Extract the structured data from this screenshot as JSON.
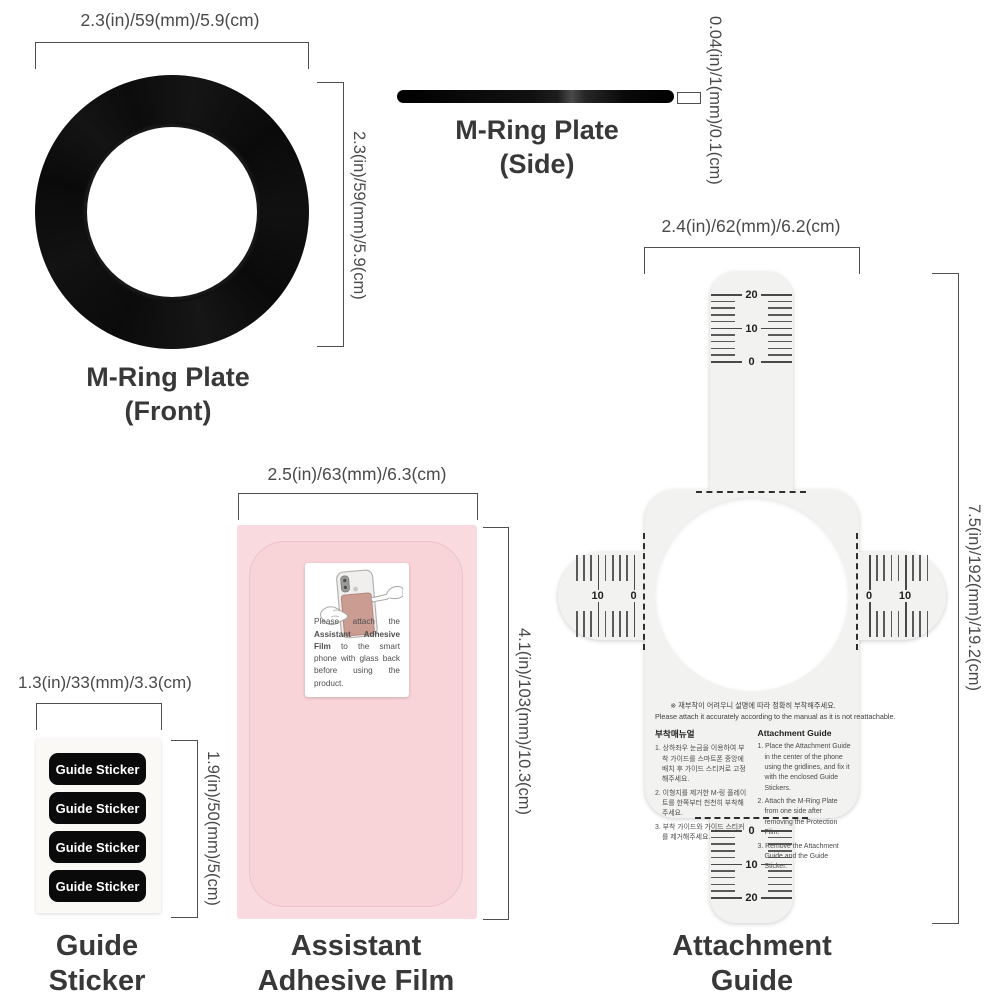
{
  "ring_front": {
    "width_dim": "2.3(in)/59(mm)/5.9(cm)",
    "height_dim": "2.3(in)/59(mm)/5.9(cm)",
    "label_line1": "M-Ring Plate",
    "label_line2": "(Front)",
    "color": "#0d0d0d"
  },
  "ring_side": {
    "thickness_dim": "0.04(in)/1(mm)/0.1(cm)",
    "label_line1": "M-Ring Plate",
    "label_line2": "(Side)"
  },
  "attachment_guide": {
    "width_dim": "2.4(in)/62(mm)/6.2(cm)",
    "height_dim": "7.5(in)/192(mm)/19.2(cm)",
    "label_line1": "Attachment",
    "label_line2": "Guide",
    "rulers": {
      "top": [
        "20",
        "10",
        "0"
      ],
      "bottom": [
        "0",
        "10",
        "20"
      ],
      "left": [
        "10",
        "0"
      ],
      "right": [
        "0",
        "10"
      ]
    },
    "notice_ko": "※ 재부착이 어려우니 설명에 따라 정확히 부착해주세요.",
    "notice_en": "Please attach it accurately according to the manual as it is not reattachable.",
    "manual_ko": {
      "title": "부착매뉴얼",
      "items": [
        "1. 상하좌우 눈금을 이용하여 부착 가이드를 스마트폰 중앙에 배치 후 가이드 스티커로 고정해주세요.",
        "2. 이형지를 제거한 M-링 플레이트를 한쪽부터 천천히 부착해주세요.",
        "3. 부착 가이드와 가이드 스티커를 제거해주세요."
      ]
    },
    "manual_en": {
      "title": "Attachment Guide",
      "items": [
        "1. Place the Attachment Guide in the center of the phone using the gridlines, and fix it with the enclosed Guide Stickers.",
        "2. Attach the M-Ring Plate from one side after removing the Protection Film.",
        "3. Remove the Attachment Guide and the Guide Sticker."
      ]
    },
    "body_color": "#f2f2f0"
  },
  "adhesive_film": {
    "width_dim": "2.5(in)/63(mm)/6.3(cm)",
    "height_dim": "4.1(in)/103(mm)/10.3(cm)",
    "label_line1": "Assistant",
    "label_line2": "Adhesive Film",
    "sticker_text_prefix": "Please attach the ",
    "sticker_text_bold": "Assistant Adhesive Film",
    "sticker_text_suffix": " to the smart phone with glass back before using the product.",
    "color": "#f8d6da"
  },
  "guide_sticker": {
    "width_dim": "1.3(in)/33(mm)/3.3(cm)",
    "height_dim": "1.9(in)/50(mm)/5(cm)",
    "label_line1": "Guide",
    "label_line2": "Sticker",
    "stickers": [
      "Guide Sticker",
      "Guide Sticker",
      "Guide Sticker",
      "Guide Sticker"
    ]
  }
}
